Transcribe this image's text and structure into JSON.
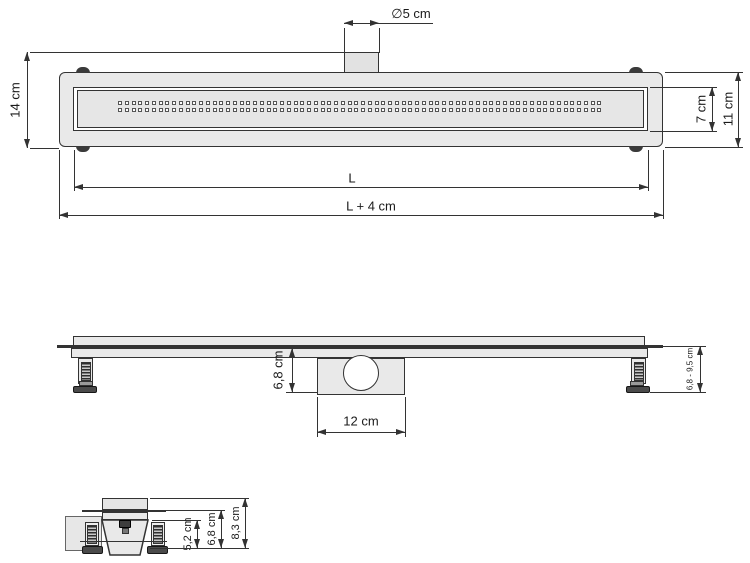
{
  "colors": {
    "line": "#333333",
    "fill_light": "#e9e9e9",
    "fill_grate": "#e6e6e6",
    "fill_dark": "#4a4a4a",
    "background": "#ffffff"
  },
  "top_view": {
    "pipe_diameter_label": "∅5 cm",
    "height_overall_label": "14 cm",
    "grate_height_label": "7 cm",
    "body_height_label": "11 cm",
    "channel_length_label": "L",
    "overall_length_label": "L + 4 cm",
    "grate_hole_rows": 2,
    "grate_holes_per_row": 72
  },
  "side_view": {
    "outlet_depth_label": "6,8 cm",
    "outlet_width_label": "12 cm",
    "height_range_label": "6,8 - 9,5 cm"
  },
  "end_view": {
    "channel_depth_label": "5,2 cm",
    "mid_depth_label": "6,8 cm",
    "overall_depth_label": "8,3 cm"
  }
}
